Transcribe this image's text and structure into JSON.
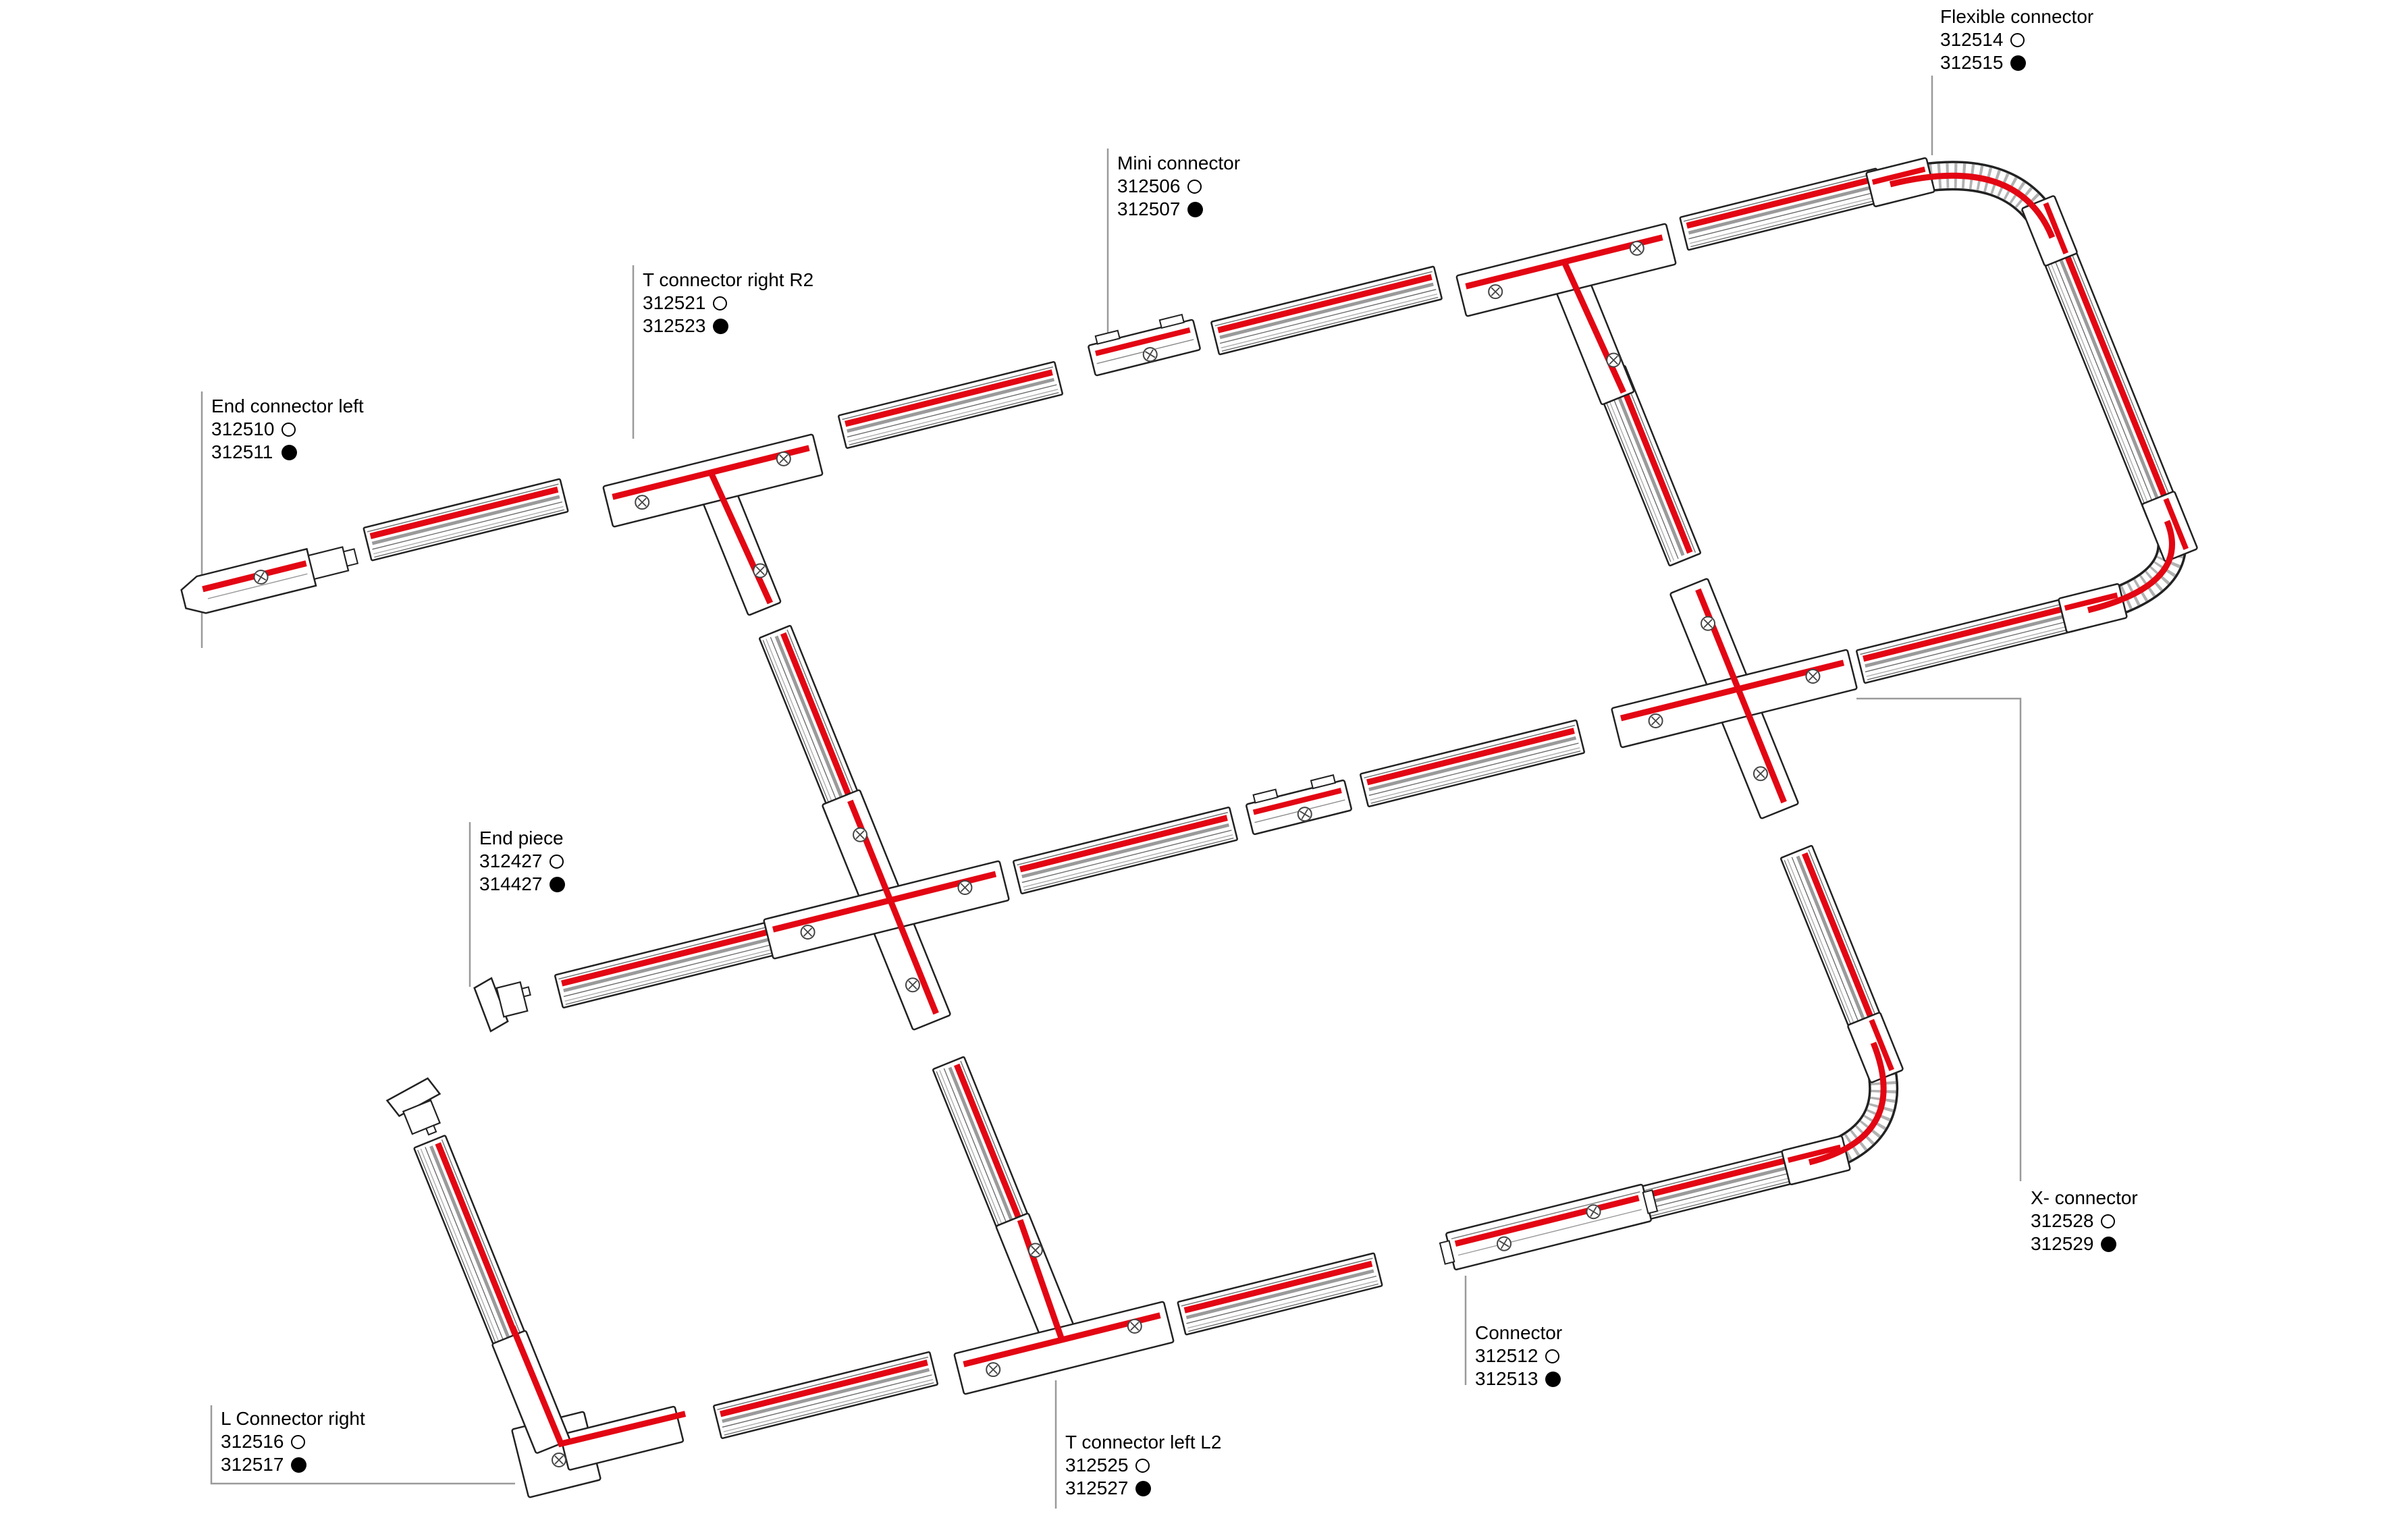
{
  "colors": {
    "accent_red": "#e30613",
    "outline": "#222222",
    "leader_gray": "#9a9a9a"
  },
  "labels": {
    "flexible_connector": {
      "name": "Flexible connector",
      "code_open": "312514",
      "code_filled": "312515"
    },
    "mini_connector": {
      "name": "Mini connector",
      "code_open": "312506",
      "code_filled": "312507"
    },
    "t_connector_right_r2": {
      "name": "T connector right R2",
      "code_open": "312521",
      "code_filled": "312523"
    },
    "end_connector_left": {
      "name": "End connector left",
      "code_open": "312510",
      "code_filled": "312511"
    },
    "end_piece": {
      "name": "End piece",
      "code_open": "312427",
      "code_filled": "314427"
    },
    "x_connector": {
      "name": "X- connector",
      "code_open": "312528",
      "code_filled": "312529"
    },
    "connector": {
      "name": "Connector",
      "code_open": "312512",
      "code_filled": "312513"
    },
    "t_connector_left_l2": {
      "name": "T connector left L2",
      "code_open": "312525",
      "code_filled": "312527"
    },
    "l_connector_right": {
      "name": "L Connector right",
      "code_open": "312516",
      "code_filled": "312517"
    }
  }
}
